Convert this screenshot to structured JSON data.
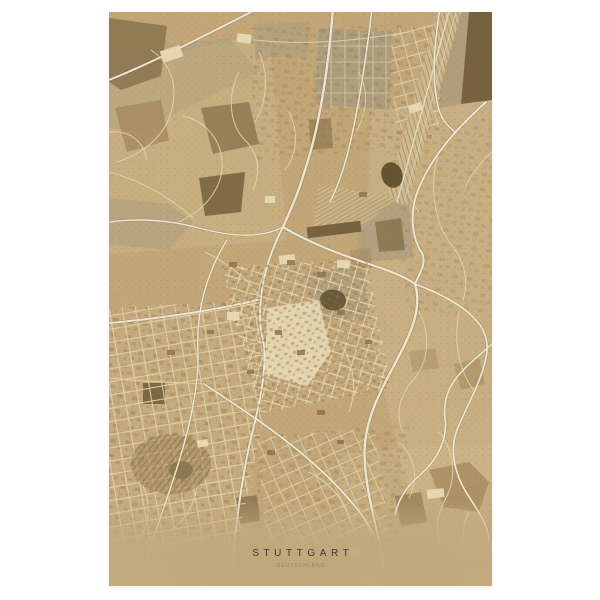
{
  "poster": {
    "title": "STUTTGART",
    "subtitle": "DEUTSCHLAND",
    "colors": {
      "page_bg": "#ffffff",
      "paper": "#c7aa7b",
      "paper_light": "#d5bf92",
      "paper_cream": "#f0e3bd",
      "road_white": "#f5efdf",
      "road_minor": "#e9dbb5",
      "patch_dark": "#6b5835",
      "patch_olive": "#857048",
      "patch_brown": "#a3865a",
      "patch_gray": "#ac9e81",
      "water_dark": "#564929",
      "block_dark": "#8a7045",
      "fade_band": "#c6ac80",
      "title_color": "#3f3930",
      "subtitle_color": "#8e7d5e"
    }
  }
}
